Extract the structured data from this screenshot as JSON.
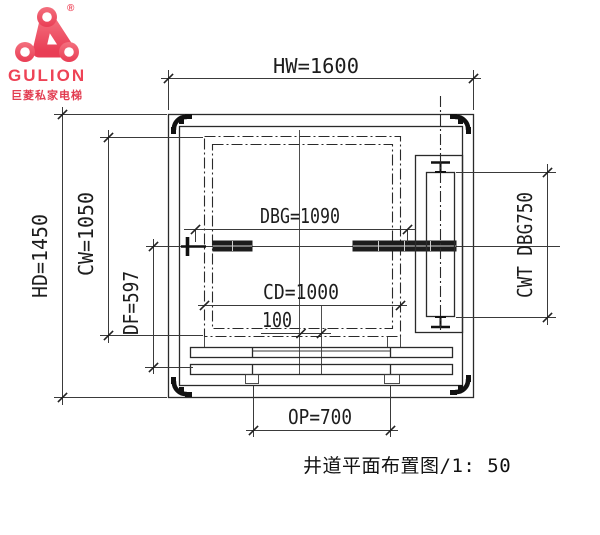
{
  "brand": {
    "name": "GULION",
    "tagline": "巨菱私家电梯",
    "registered": "®",
    "logo_color": "#ee4b5e"
  },
  "drawing": {
    "title_caption": "井道平面布置图/1: 50",
    "dimensions": {
      "hw": "HW=1600",
      "hd": "HD=1450",
      "cw": "CW=1050",
      "df": "DF=597",
      "dbg": "DBG=1090",
      "cd": "CD=1000",
      "door_offset": "100",
      "cwt": "CWT DBG750",
      "op": "OP=700"
    },
    "line_color": "#2a2a2a"
  }
}
